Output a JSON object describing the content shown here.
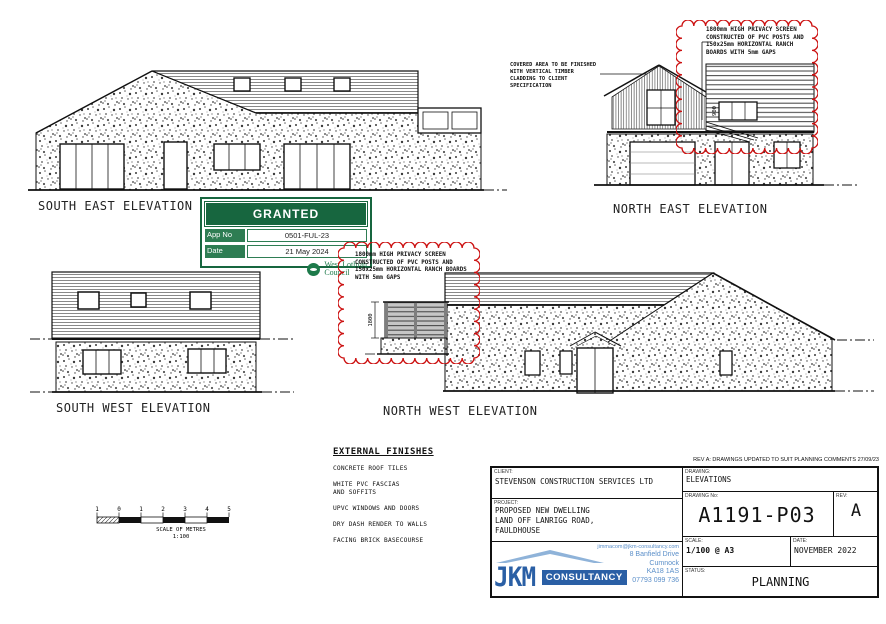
{
  "colors": {
    "red": "#cc1111",
    "green": "#17663f",
    "blue": "#2a5fa5"
  },
  "elevation_labels": {
    "south_east": "SOUTH EAST ELEVATION",
    "north_east": "NORTH EAST ELEVATION",
    "south_west": "SOUTH WEST ELEVATION",
    "north_west": "NORTH WEST ELEVATION"
  },
  "annotations": {
    "privacy_screen": "1800mm HIGH PRIVACY SCREEN CONSTRUCTED OF PVC POSTS AND 150x25mm HORIZONTAL RANCH BOARDS WITH 5mm GAPS",
    "covered_area": "COVERED AREA TO BE FINISHED WITH VERTICAL TIMBER CLADDING TO CLIENT SPECIFICATION",
    "screen_height_dim": "1800",
    "ne_window_dim": "900"
  },
  "stamp": {
    "title": "GRANTED",
    "app_no_label": "App No",
    "app_no": "0501-FUL-23",
    "date_label": "Date",
    "date": "21 May 2024",
    "council_line1": "West Lothian",
    "council_line2": "Council"
  },
  "external_finishes": {
    "title": "EXTERNAL FINISHES",
    "items": [
      "CONCRETE ROOF TILES",
      "WHITE PVC FASCIAS\nAND SOFFITS",
      "UPVC WINDOWS AND DOORS",
      "DRY DASH RENDER TO WALLS",
      "FACING BRICK BASECOURSE"
    ]
  },
  "scale_bar": {
    "numbers": [
      "1",
      "0",
      "1",
      "2",
      "3",
      "4",
      "5"
    ],
    "caption": "SCALE OF METRES",
    "ratio": "1:100"
  },
  "title_block": {
    "rev_note": "REV A: DRAWINGS UPDATED TO SUIT PLANNING COMMENTS  27/09/23",
    "client_label": "CLIENT:",
    "client": "STEVENSON CONSTRUCTION SERVICES LTD",
    "project_label": "PROJECT:",
    "project": "PROPOSED NEW DWELLING\nLAND OFF LANRIGG ROAD,\nFAULDHOUSE",
    "drawing_label": "DRAWING:",
    "drawing": "ELEVATIONS",
    "drawing_no_label": "DRAWING No:",
    "drawing_no": "A1191-P03",
    "rev_label": "REV:",
    "rev": "A",
    "scale_label": "SCALE:",
    "scale": "1/100 @ A3",
    "date_label": "DATE:",
    "date": "NOVEMBER 2022",
    "status_label": "STATUS:",
    "status": "PLANNING",
    "logo_jkm": "JKM",
    "logo_consultancy": "CONSULTANCY",
    "contact_email": "jimmacom@jkm-consultancy.com",
    "contact_address1": "8 Banfield Drive",
    "contact_address2": "Cumnock",
    "contact_postcode": "KA18 1AS",
    "contact_phone": "07793 099 736"
  }
}
